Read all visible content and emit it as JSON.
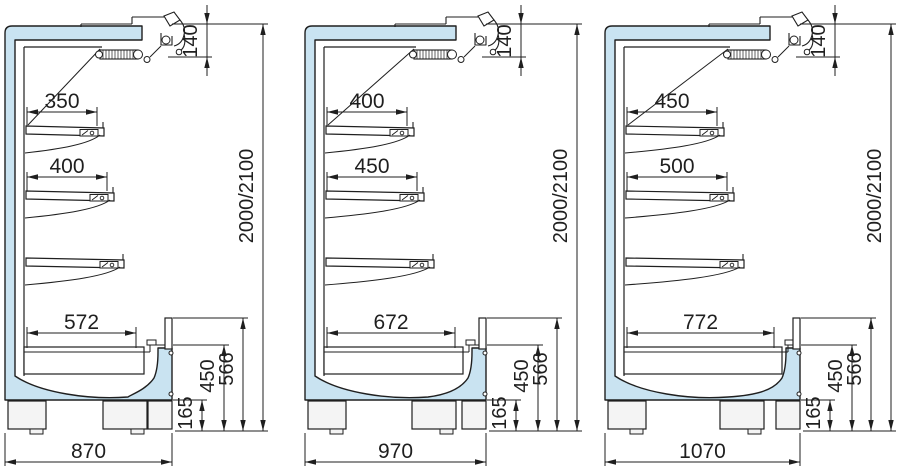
{
  "diagram": {
    "description": "Side cross-section drawings of three multideck display cabinets with dimensions in mm",
    "colors": {
      "line": "#1f1f1f",
      "panel_fill": "#c9e3f1",
      "foot_fill": "#f4f4f4",
      "background": "#ffffff"
    },
    "units": [
      {
        "labels": {
          "shelf1": "350",
          "shelf2": "400",
          "tray": "572",
          "base": "870",
          "top": "140",
          "overall": "2000/2100",
          "front": "566",
          "well": "450",
          "plinth": "165"
        },
        "mm": {
          "shelf1": 350,
          "shelf2": 400,
          "tray": 572,
          "base": 870
        }
      },
      {
        "labels": {
          "shelf1": "400",
          "shelf2": "450",
          "tray": "672",
          "base": "970",
          "top": "140",
          "overall": "2000/2100",
          "front": "566",
          "well": "450",
          "plinth": "165"
        },
        "mm": {
          "shelf1": 400,
          "shelf2": 450,
          "tray": 672,
          "base": 970
        }
      },
      {
        "labels": {
          "shelf1": "450",
          "shelf2": "500",
          "tray": "772",
          "base": "1070",
          "top": "140",
          "overall": "2000/2100",
          "front": "566",
          "well": "450",
          "plinth": "165"
        },
        "mm": {
          "shelf1": 450,
          "shelf2": 500,
          "tray": 772,
          "base": 1070
        }
      }
    ]
  }
}
